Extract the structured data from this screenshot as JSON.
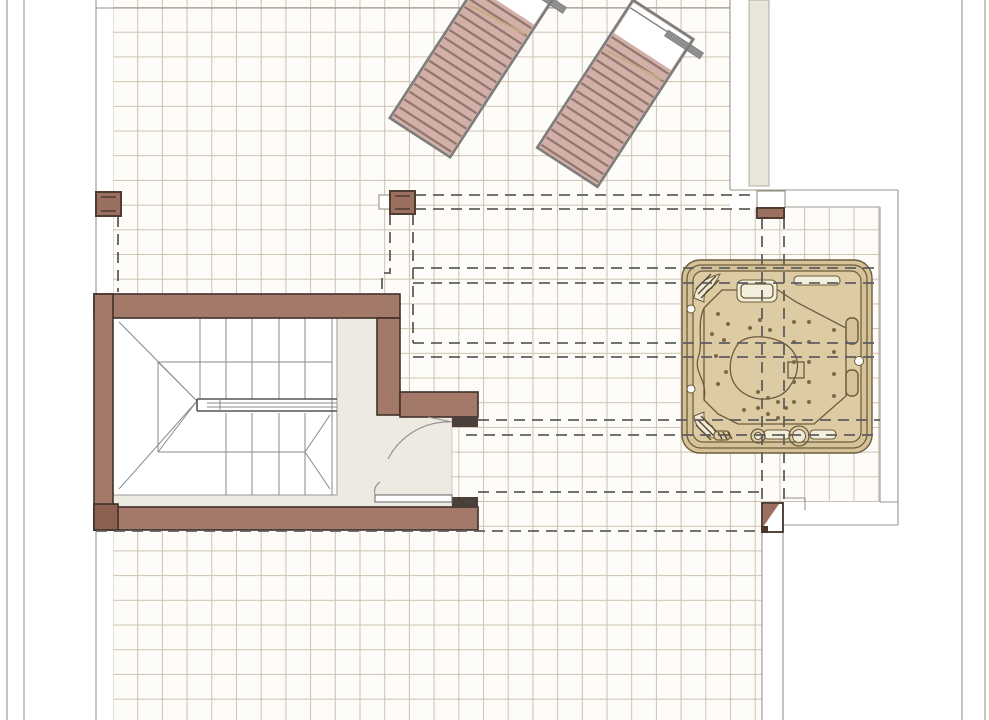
{
  "meta": {
    "drawing_type": "architectural floor plan",
    "subject": "roof terrace plan with staircase, pergola, sun loungers and hot tub",
    "has_text": false
  },
  "colors": {
    "page_bg": "#ffffff",
    "tile_bg": "#fdfcf8",
    "tile_line": "#cdc3b1",
    "boundary": "#9a948a",
    "beige_strip": "#eae6dc",
    "beige_strip_border": "#b3ab9c",
    "dash": "#5e5e5e",
    "wall": "#a5796a",
    "wall_stroke": "#3f3128",
    "wall_dark": "#8c6152",
    "cap": "#4a4039",
    "landing": "#edeae1",
    "stair_line": "#8a8a8a",
    "rail": "#555555",
    "white": "#ffffff",
    "lounger": "#d2b0a7",
    "lounger_slat": "#8e746b",
    "lounger_frame": "#7d7d7d",
    "lounger_bar": "#8f8f8f",
    "lounger_hinge": "#c5a987",
    "post": "#9b7060",
    "post_stroke": "#503c31",
    "tub_shell": "#d6c298",
    "tub_inner": "#ddcba4",
    "tub_line": "#6b5c3c",
    "tub_cream": "#f4efdc",
    "tub_cream2": "#efe9d6",
    "tub_jet": "#7d6847",
    "tub_hatch": "#55482f"
  },
  "components": {
    "terrace": {
      "label": "tiled terrace deck",
      "tile_pitch_px": 24.7
    },
    "sun_loungers": {
      "count": 2,
      "label": "slatted sun lounger",
      "rotation_deg": 33
    },
    "pergola_posts": {
      "count": 4,
      "label": "pergola post"
    },
    "pergola_beams": {
      "label": "overhead beams (dashed projection)",
      "horizontal_pairs": 5
    },
    "hot_tub": {
      "label": "square hot tub / spa with seats, jets, pillows",
      "jet_count": 32
    },
    "staircase": {
      "label": "enclosed U-shaped staircase with central rail and winders",
      "doors": 2
    },
    "upper_wall_strip": {
      "label": "wall of adjacent volume (top right)"
    }
  }
}
